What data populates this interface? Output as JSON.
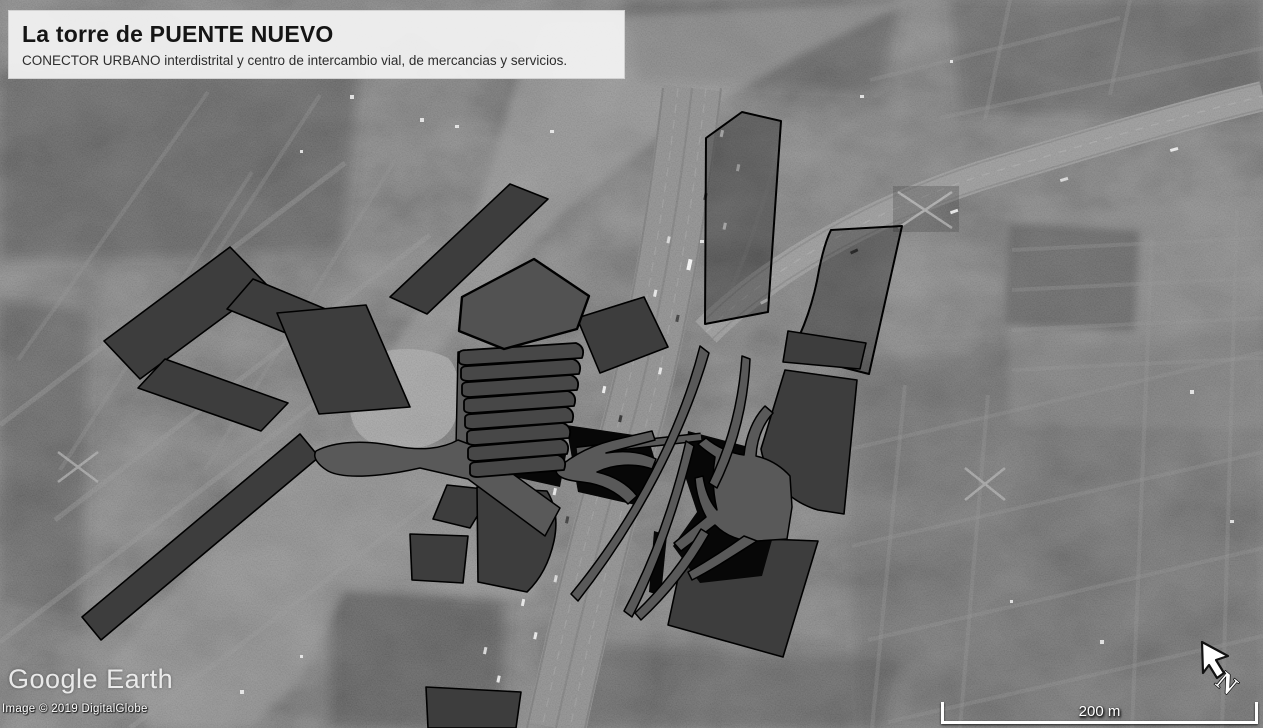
{
  "title_card": {
    "title": "La torre de PUENTE NUEVO",
    "subtitle": "CONECTOR URBANO interdistrital y centro de intercambio vial, de mercancias y servicios."
  },
  "watermark": {
    "text": "Google Earth"
  },
  "attribution": {
    "text": "Image © 2019 DigitalGlobe"
  },
  "scale_bar": {
    "label": "200 m",
    "distance_meters": 200
  },
  "north_indicator": {
    "letter": "N",
    "icon": "north-arrow-icon"
  },
  "map": {
    "type": "satellite-grayscale-oblique",
    "overlay_colors": {
      "block_fill": "#3d3d3d",
      "tower_fill": "#474747",
      "tower_roof_fill": "#525252",
      "ramp_fill": "#595959",
      "outline": "#000000"
    }
  }
}
